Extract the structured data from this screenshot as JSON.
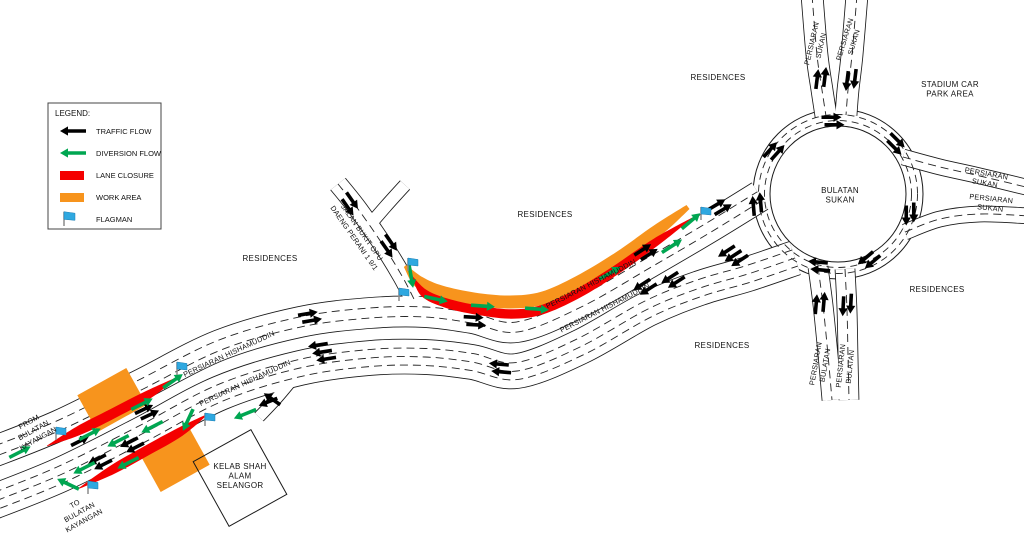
{
  "legend": {
    "title": "LEGEND:",
    "items": [
      {
        "key": "traffic-flow",
        "label": "TRAFFIC FLOW"
      },
      {
        "key": "diversion-flow",
        "label": "DIVERSION FLOW"
      },
      {
        "key": "lane-closure",
        "label": "LANE CLOSURE"
      },
      {
        "key": "work-area",
        "label": "WORK AREA"
      },
      {
        "key": "flagman",
        "label": "FLAGMAN"
      }
    ]
  },
  "roads": {
    "hishamuddin": "PERSIARAN HISHAMUDDIN",
    "sukan": "PERSIARAN\nSUKAN",
    "bulatan": "PERSIARAN\nBULATAN",
    "bulatan_sukan": "BULATAN\nSUKAN",
    "jalan_bukit_opu": "JALAN BUKIT OPU\nDAENG PERANI 1 9/1",
    "from_kayangan": "FROM\nBULATAN\nKAYANGAN",
    "to_kayangan": "TO\nBULATAN\nKAYANGAN"
  },
  "areas": {
    "residences": "RESIDENCES",
    "stadium": "STADIUM CAR\nPARK AREA",
    "kelab": "KELAB SHAH\nALAM\nSELANGOR"
  },
  "colors": {
    "traffic_flow": "#000000",
    "diversion_flow": "#00A651",
    "lane_closure": "#F40000",
    "work_area": "#F7941D",
    "flagman_blue": "#2FA8E0",
    "line": "#1a1a1a"
  }
}
